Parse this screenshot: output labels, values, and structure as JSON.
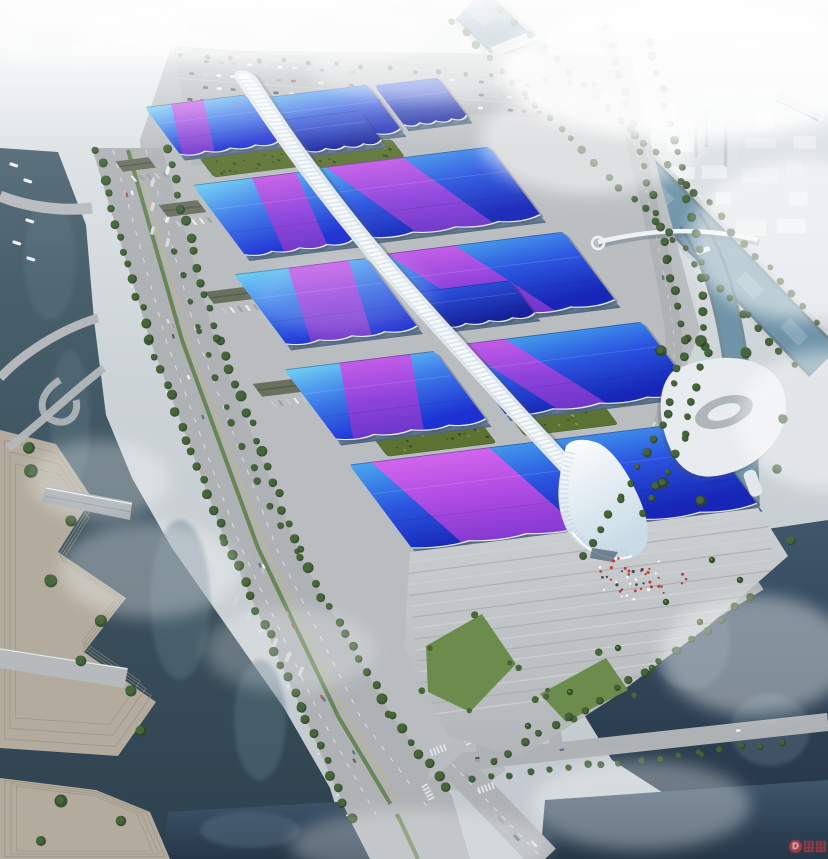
{
  "meta": {
    "scene": "hazy aerial rendering of a riverside exhibition and convention center with blue ribbon roofs and a white central corridor"
  },
  "watermark": {
    "letter": "D",
    "color": "#c23b45"
  },
  "palette": {
    "skyTop": "#e6ebed",
    "skyMid": "#ccd3d7",
    "skyBot": "#c2c9ce",
    "city": "#eef1f2",
    "cityShade": "#d5dbde",
    "tower": "#dde4e8",
    "towerShade": "#b9c2c8",
    "ground": "#b9bdc0",
    "road": "#aeb2b5",
    "roadLight": "#b8bcbf",
    "laneWhite": "#e8eaeb",
    "laneYellow": "#c9bc62",
    "median": "#5d7d45",
    "waterWest1": "#4e6673",
    "waterWest2": "#2e414e",
    "waterSE1": "#3f566b",
    "waterSE2": "#253647",
    "canal1": "#6f94a8",
    "canal2": "#9ab7c6",
    "quay": "#c6cdd2",
    "bankShade": "#55707e",
    "terrace": "#b2ab9e",
    "terraceLine": "#99927f",
    "treeDark": "#2e4526",
    "treeMid": "#47663a",
    "treeLight": "#6e9247",
    "lawn": "#6b8c4d",
    "roofCyan": "#6fd2f4",
    "roofBlue": "#3f7dea",
    "roofRoyal": "#1d30d2",
    "roofB1": "#49a9ee",
    "roofB2": "#2b55e0",
    "roofB3": "#1726b6",
    "roofDeep1": "#2d55e2",
    "roofDeep2": "#15209a",
    "ribbon1": "#cf5ae8",
    "ribbon2": "#9442dc",
    "ribbon3": "#6c34c6",
    "magenta1": "#dc64ee",
    "magenta2": "#b44ae2",
    "magenta3": "#8438d0",
    "spineLight": "#f5f9fb",
    "spineBase": "#dfe7ec",
    "spineDots": "#b6c9d4",
    "facade1": "#7e95a8",
    "facade2": "#49607a",
    "greenRoof": "#5c7233",
    "greenRoofDark": "#394f1d",
    "shed": "#68705e",
    "shedRidge": "#525a48",
    "canopy1": "#ffffff",
    "canopy2": "#c9dbe6",
    "plaza1": "#ccd0d2",
    "plaza2": "#b2b6b9",
    "stepLight": "#d0d3d5",
    "stepShade": "#a9adb0",
    "landmark": "#e9ecee",
    "landmarkShade": "#aeb6ba",
    "peopleRed": "#c23a3a",
    "boat": "#eef1f2"
  },
  "scene": {
    "spine": {
      "id": "central-corridor",
      "path": "M 4 -16 C -2 60 -4 140 4 230 C 10 290 16 340 24 410 C 30 455 34 490 40 522",
      "width": 21
    },
    "halls": [
      {
        "id": "hall-north-west",
        "lx": -112,
        "ly": 2,
        "w": 104,
        "h": 60,
        "grad": "A",
        "ribbon": {
          "t0": 0.28,
          "t1": 0.6,
          "shift": -0.3
        },
        "facade": true
      },
      {
        "id": "hall-north-east",
        "lx": 8,
        "ly": 8,
        "w": 106,
        "h": 58,
        "grad": "B",
        "facade": true
      },
      {
        "id": "hall-north-east-2",
        "lx": 120,
        "ly": 10,
        "w": 66,
        "h": 50,
        "grad": "deep",
        "facade": true
      },
      {
        "id": "hall-north-east-annex",
        "lx": 10,
        "ly": 36,
        "w": 78,
        "h": 40,
        "grad": "deep",
        "facade": true
      },
      {
        "id": "hall-west-1",
        "lx": -122,
        "ly": 98,
        "w": 113,
        "h": 88,
        "grad": "A",
        "ribbon": {
          "t0": 0.55,
          "t1": 0.95,
          "shift": -0.22
        },
        "facade": true
      },
      {
        "id": "hall-east-1",
        "lx": 9,
        "ly": 96,
        "w": 176,
        "h": 88,
        "grad": "B",
        "ribbon": {
          "t0": 0.03,
          "t1": 0.48,
          "shift": 0.26
        },
        "facade": true
      },
      {
        "id": "hall-west-2",
        "lx": -146,
        "ly": 206,
        "w": 136,
        "h": 88,
        "grad": "A",
        "ribbon": {
          "t0": 0.42,
          "t1": 0.88,
          "shift": -0.26
        },
        "facade": true
      },
      {
        "id": "hall-east-2",
        "lx": 10,
        "ly": 204,
        "w": 185,
        "h": 88,
        "grad": "B",
        "ribbon": {
          "t0": 0.0,
          "t1": 0.38,
          "shift": 0.3
        },
        "facade": true
      },
      {
        "id": "hall-east-2-annex",
        "lx": 14,
        "ly": 252,
        "w": 96,
        "h": 44,
        "grad": "deep",
        "facade": true
      },
      {
        "id": "hall-west-3",
        "lx": -166,
        "ly": 322,
        "w": 155,
        "h": 88,
        "grad": "A",
        "ribbon": {
          "t0": 0.38,
          "t1": 0.85,
          "shift": -0.3
        },
        "facade": true
      },
      {
        "id": "hall-east-3",
        "lx": 11,
        "ly": 318,
        "w": 194,
        "h": 88,
        "grad": "B",
        "ribbon": {
          "t0": 0.0,
          "t1": 0.26,
          "shift": 0.3
        },
        "facade": true
      },
      {
        "id": "grand-hall",
        "lx": -172,
        "ly": 440,
        "w": 357,
        "h": 105,
        "grad": "B",
        "ribbon": {
          "t0": 0.06,
          "t1": 0.4,
          "shift": 0.09,
          "grad": "magenta"
        },
        "facade": true,
        "waves": 6
      }
    ],
    "green_roofs": [
      {
        "id": "green-roof-west-1",
        "lx": -96,
        "ly": 68,
        "w": 86,
        "h": 24
      },
      {
        "id": "green-roof-east-1",
        "lx": 10,
        "ly": 74,
        "w": 88,
        "h": 22
      },
      {
        "id": "green-roof-west-2",
        "lx": -130,
        "ly": 414,
        "w": 112,
        "h": 22
      },
      {
        "id": "green-roof-east-2",
        "lx": 14,
        "ly": 410,
        "w": 96,
        "h": 22
      }
    ],
    "service_sheds": [
      {
        "x": -168,
        "y": 116,
        "w": 40,
        "h": 15
      },
      {
        "x": -186,
        "y": 222,
        "w": 44,
        "h": 15
      },
      {
        "x": -206,
        "y": 334,
        "w": 46,
        "h": 16
      },
      {
        "x": -178,
        "y": 60,
        "w": 34,
        "h": 13
      }
    ],
    "people_cluster": {
      "cx": 640,
      "cy": 578,
      "count": 46
    },
    "boat_count": 6
  }
}
